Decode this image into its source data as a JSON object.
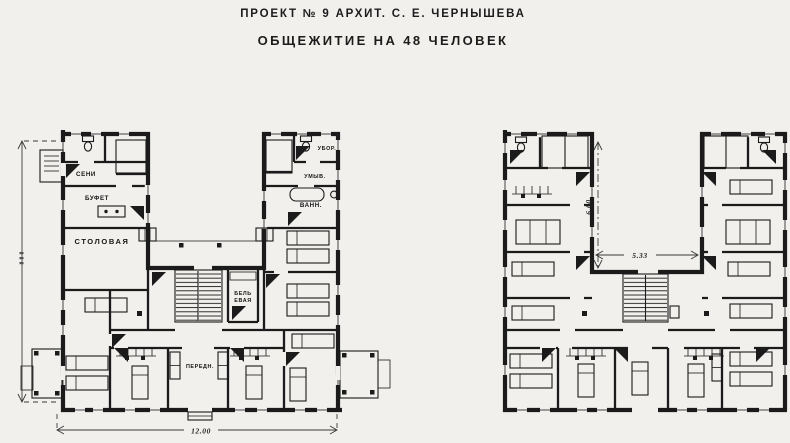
{
  "header": {
    "line1": "ПРОЕКТ № 9 АРХИТ. С. Е. ЧЕРНЫШЕВА",
    "line2": "ОБЩЕЖИТИЕ НА 48 ЧЕЛОВЕК"
  },
  "left_plan": {
    "rooms": {
      "seni": "СЕНИ",
      "bufet": "БУФЕТ",
      "stolovaya": "СТОЛОВАЯ",
      "ubor": "УБОР.",
      "umyv": "УМЫВ.",
      "vann": "ВАНН.",
      "belyevaya_line1": "БЕЛЬ",
      "belyevaya_line2": "ЕВАЯ",
      "perednyaya": "ПЕРЕДН."
    },
    "dimensions": {
      "overall_width": "12.00"
    }
  },
  "right_plan": {
    "dimensions": {
      "courtyard_depth": "6.00",
      "courtyard_width": "5.33"
    }
  },
  "colors": {
    "paper": "#f1f0ed",
    "ink": "#1b1b1b"
  }
}
